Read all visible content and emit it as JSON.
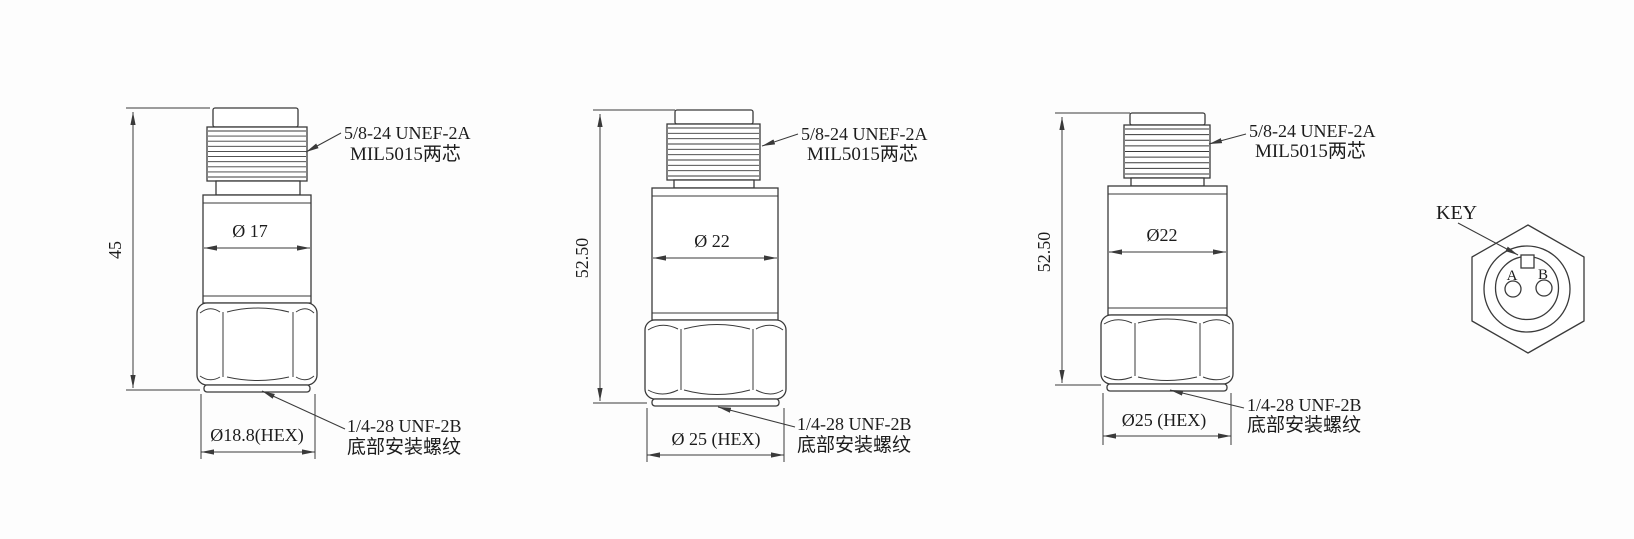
{
  "drawing": {
    "background_color": "#fdfdfd",
    "line_color": "#3a3a3a",
    "text_color": "#1c1c1c",
    "figures": [
      {
        "height_dim": "45",
        "body_diameter_dim": "Ø 17",
        "hex_width_dim": "Ø18.8(HEX)",
        "thread_spec_line1": "5/8-24 UNEF-2A",
        "thread_spec_line2": "MIL5015两芯",
        "mount_thread_line1": "1/4-28 UNF-2B",
        "mount_thread_line2": "底部安装螺纹"
      },
      {
        "height_dim": "52.50",
        "body_diameter_dim": "Ø 22",
        "hex_width_dim": "Ø 25 (HEX)",
        "thread_spec_line1": "5/8-24 UNEF-2A",
        "thread_spec_line2": "MIL5015两芯",
        "mount_thread_line1": "1/4-28 UNF-2B",
        "mount_thread_line2": "底部安装螺纹"
      },
      {
        "height_dim": "52.50",
        "body_diameter_dim": "Ø22",
        "hex_width_dim": "Ø25 (HEX)",
        "thread_spec_line1": "5/8-24 UNEF-2A",
        "thread_spec_line2": "MIL5015两芯",
        "mount_thread_line1": "1/4-28 UNF-2B",
        "mount_thread_line2": "底部安装螺纹"
      }
    ],
    "connector": {
      "key_label": "KEY",
      "pin_a_label": "A",
      "pin_b_label": "B"
    }
  }
}
